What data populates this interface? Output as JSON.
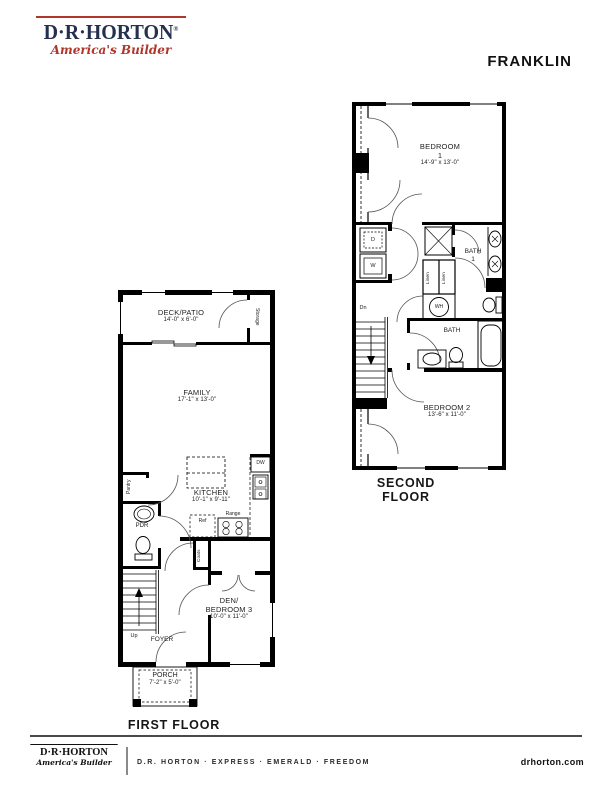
{
  "header": {
    "logo": {
      "name": "D·R·HORTON",
      "registered": "®",
      "tagline": "America's Builder"
    },
    "plan_title": "FRANKLIN"
  },
  "second_floor": {
    "caption": "SECOND FLOOR",
    "bedroom1_label": "BEDROOM",
    "bedroom1_number": "1",
    "bedroom1_dims": "14'-9\" x 13'-0\"",
    "bath1_label": "BATH",
    "bath1_number": "1",
    "bath2_label": "BATH",
    "bedroom2_label": "BEDROOM 2",
    "bedroom2_dims": "13'-6\" x 11'-0\"",
    "dryer": "D",
    "washer": "W",
    "water_heater": "WH",
    "linen1": "Linen",
    "linen2": "Linen",
    "stairs_down": "Dn"
  },
  "first_floor": {
    "caption": "FIRST FLOOR",
    "deck_label": "DECK/PATIO",
    "deck_dims": "14'-0\" x 6'-0\"",
    "storage": "Storage",
    "family_label": "FAMILY",
    "family_dims": "17'-1\" x 13'-0\"",
    "kitchen_label": "KITCHEN",
    "kitchen_dims": "10'-1\" x 9'-11\"",
    "pantry": "Pantry",
    "powder_room": "PDR",
    "refrigerator": "Ref",
    "range": "Range",
    "dishwasher": "DW",
    "coats": "Coats",
    "stairs_up": "Up",
    "foyer": "FOYER",
    "den_label1": "DEN/",
    "den_label2": "BEDROOM 3",
    "den_dims": "10'-0\" x 11'-0\"",
    "porch_label": "PORCH",
    "porch_dims": "7'-2\" x 5'-0\""
  },
  "footer": {
    "logo_name": "D·R·HORTON",
    "logo_tagline": "America's Builder",
    "brands": "D.R. HORTON · EXPRESS · EMERALD · FREEDOM",
    "website": "drhorton.com"
  },
  "colors": {
    "brand_navy": "#25304f",
    "brand_red": "#b0362c",
    "wall": "#000000"
  }
}
